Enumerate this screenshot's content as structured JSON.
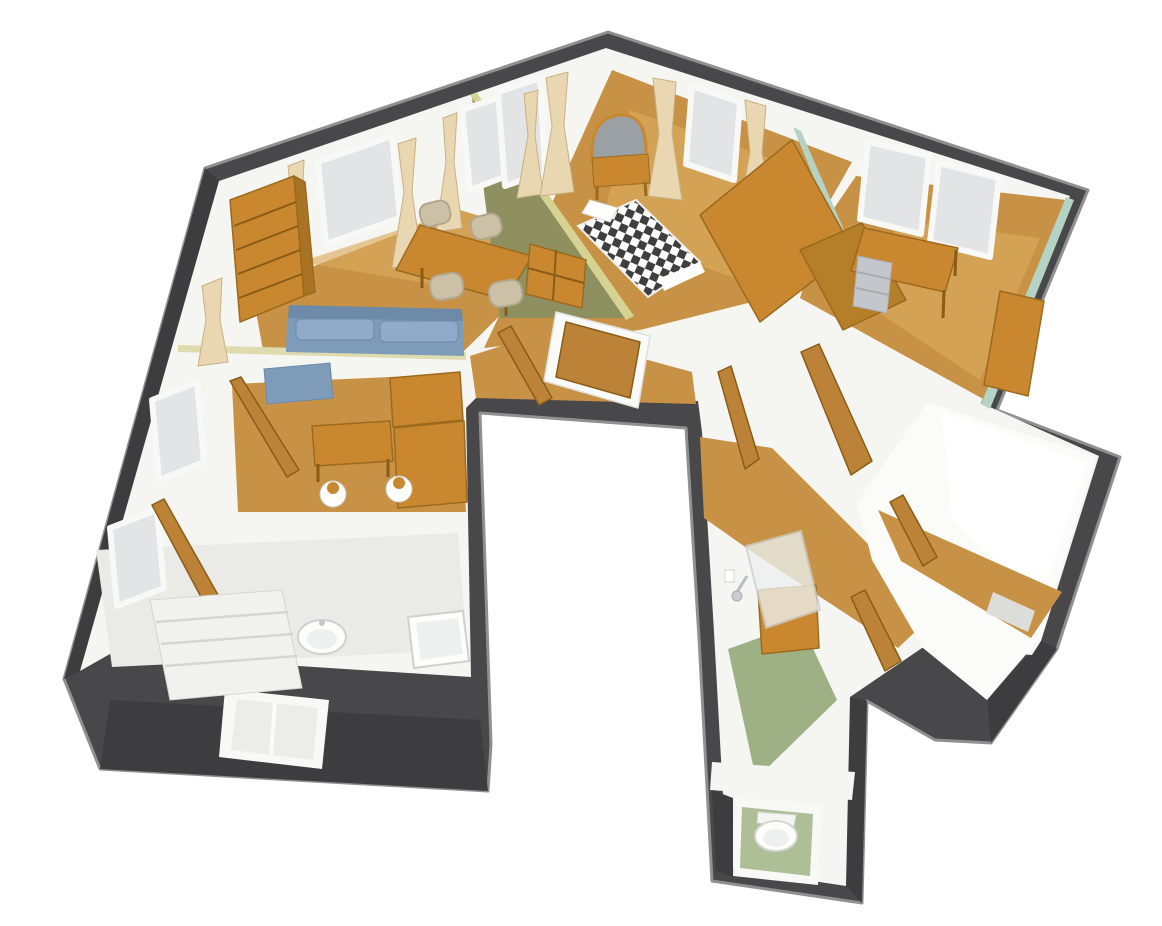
{
  "meta": {
    "description": "Cutaway 3D rendered floor plan of a furnished apartment viewed from above at an angle, on a plain background. No text or UI chrome is visible.",
    "width_px": 1162,
    "height_px": 926
  },
  "colors": {
    "background": "#ffffff",
    "outer_wall": "#48484b",
    "outer_wall_shadow": "#3d3d40",
    "outer_wall_edge": "#909093",
    "inner_wall": "#f5f5f2",
    "floor_wood": "#c79245",
    "floor_wood_light": "#dbaa5e",
    "floor_tile": "#eaeae7",
    "floor_bright": "#fbfbf9",
    "floor_green": "#9db185",
    "furniture_wood": "#c9882f",
    "furniture_wood_dark": "#9c6a1f",
    "door_wood": "#bc8338",
    "sofa_blue": "#7e9bba",
    "sofa_blue_light": "#8fabc7",
    "chair_tan": "#ccc0a6",
    "curtain": "#e8d7b0",
    "olive_wall": "#8f9060",
    "olive_wall_edge": "#d6d292",
    "pale_wall_top": "#dedcae",
    "teal_wall": "#b5d3c5",
    "window_glass": "#e2e4e6",
    "window_frame": "#f8f8f6",
    "mirror_gray": "#9aa0a4",
    "metal_gray": "#c3c7cb",
    "fixture_white": "#fdfdfc",
    "fixture_inner": "#eef0ef",
    "checker_dark": "#3f3f3f",
    "checker_light": "#fdfdfd",
    "step_gray": "#dcdcd9",
    "stair_tread": "#f1f1ee",
    "toilet_green": "#aebf97"
  },
  "rooms": [
    {
      "name": "living-room",
      "position": "top-left",
      "floor": "wood",
      "items": [
        "bookshelf",
        "two windows with curtains",
        "dining table",
        "four chairs",
        "cubby shelf unit",
        "blue two-seat sofa"
      ]
    },
    {
      "name": "bedroom",
      "position": "top-center",
      "floor": "wood",
      "items": [
        "dressing table with arched mirror",
        "two windows with curtains",
        "double bed with black-white checkered cover",
        "white pillow",
        "wardrobe",
        "chest of drawers"
      ]
    },
    {
      "name": "office",
      "position": "top-right",
      "floor": "wood",
      "items": [
        "two windows",
        "desk",
        "metal drawer unit",
        "tall cabinet"
      ]
    },
    {
      "name": "kitchen",
      "position": "middle-left",
      "floor": "wood",
      "items": [
        "open door",
        "blue counter",
        "small table",
        "two round stools",
        "wooden cabinets"
      ]
    },
    {
      "name": "bathroom",
      "position": "bottom-left",
      "floor": "tile",
      "items": [
        "open door",
        "staircase",
        "wall basin",
        "bathtub",
        "side windows",
        "exterior window in dark wall"
      ]
    },
    {
      "name": "hallway",
      "position": "center",
      "floor": "wood",
      "items": [
        "open wooden doors"
      ]
    },
    {
      "name": "corridor",
      "position": "center-right",
      "floor": "wood",
      "items": [
        "several open wooden doors"
      ]
    },
    {
      "name": "shower-room",
      "position": "bottom-center",
      "floor": "green",
      "items": [
        "shower head",
        "glass shower screen"
      ]
    },
    {
      "name": "toilet",
      "position": "bottom",
      "floor": "green",
      "items": [
        "toilet",
        "window opening in dark exterior wall"
      ]
    },
    {
      "name": "back-room",
      "position": "right",
      "floor": "wood and white",
      "items": [
        "open door",
        "small floor step"
      ]
    }
  ]
}
